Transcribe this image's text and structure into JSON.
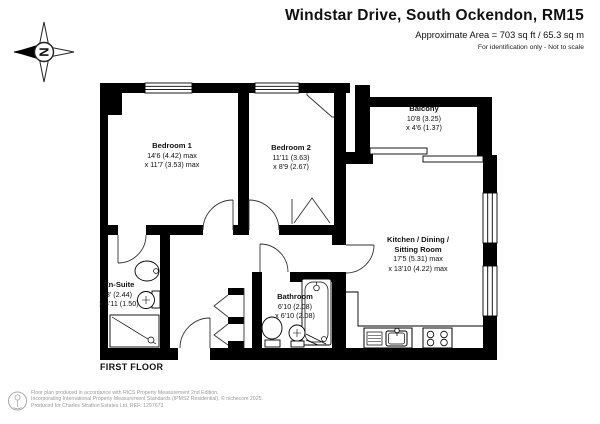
{
  "header": {
    "title": "Windstar Drive, South Ockendon, RM15",
    "area_line": "Approximate Area = 703 sq ft / 65.3 sq m",
    "disclaimer": "For identification only - Not to scale"
  },
  "compass": {
    "north_label": "N"
  },
  "floor_label": "FIRST FLOOR",
  "rooms": [
    {
      "name": "Bedroom 1",
      "dim1": "14'6 (4.42) max",
      "dim2": "x 11'7 (3.53) max"
    },
    {
      "name": "Bedroom 2",
      "dim1": "11'11 (3.63)",
      "dim2": "x 8'9 (2.67)"
    },
    {
      "name": "Balcony",
      "dim1": "10'8 (3.25)",
      "dim2": "x 4'6 (1.37)"
    },
    {
      "name": "Kitchen / Dining /",
      "name2": "Sitting Room",
      "dim1": "17'5 (5.31) max",
      "dim2": "x 13'10 (4.22) max"
    },
    {
      "name": "En-Suite",
      "dim1": "8' (2.44)",
      "dim2": "x 4'11 (1.50)"
    },
    {
      "name": "Bathroom",
      "dim1": "6'10 (2.08)",
      "dim2": "x 6'10 (2.08)"
    }
  ],
  "footer": {
    "line1": "Floor plan produced in accordance with RICS Property Measurement 2nd Edition,",
    "line2": "Incorporating International Property Measurement Standards (IPMS2 Residential).  © nichecom 2025.",
    "line3": "Produced for Charles Stratton Estates Ltd.   REF: 1297673"
  },
  "colors": {
    "wall": "#000000",
    "text": "#111111",
    "footer_text": "#999999"
  }
}
